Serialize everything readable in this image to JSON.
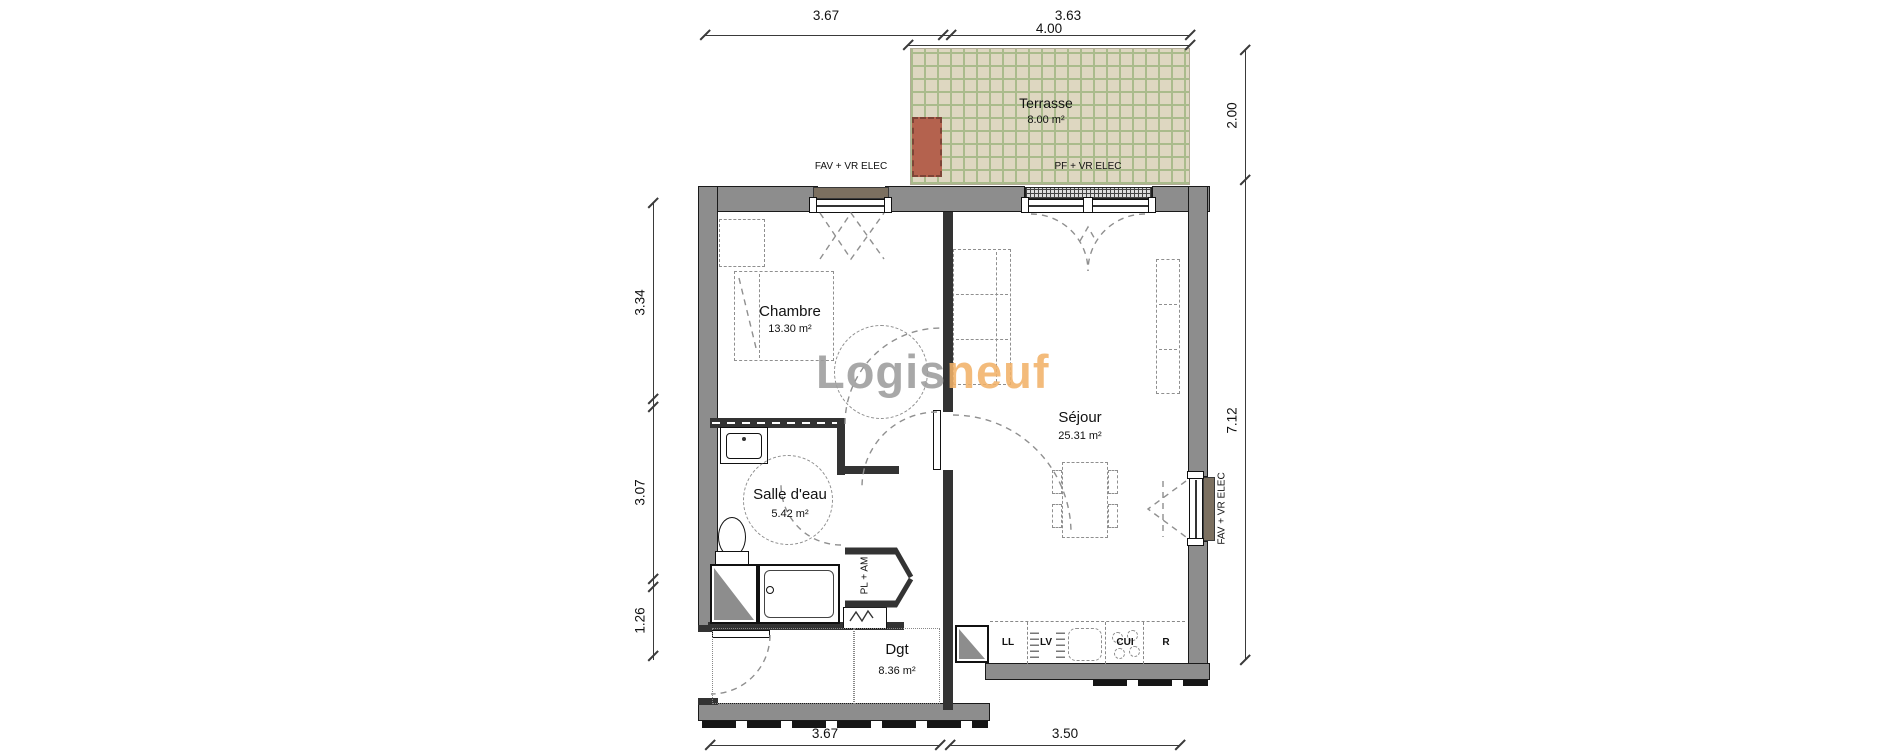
{
  "watermark": {
    "part1": "Logis",
    "part2": "neuf"
  },
  "rooms": {
    "terrasse": {
      "name": "Terrasse",
      "area": "8.00 m²"
    },
    "chambre": {
      "name": "Chambre",
      "area": "13.30 m²"
    },
    "sejour": {
      "name": "Séjour",
      "area": "25.31 m²"
    },
    "salle_eau": {
      "name": "Salle d'eau",
      "area": "5.42 m²"
    },
    "dgt": {
      "name": "Dgt",
      "area": "8.36 m²"
    }
  },
  "windows": {
    "fav_top": "FAV + VR ELEC",
    "pf_top": "PF + VR ELEC",
    "fav_right": "FAV + VR ELEC"
  },
  "closet": {
    "label": "PL + AM"
  },
  "kitchen": {
    "ll": "LL",
    "lv": "LV",
    "cui": "CUI",
    "r": "R"
  },
  "dimensions": {
    "top_left": "3.67",
    "top_right": "3.63",
    "terrace": "4.00",
    "right_upper": "2.00",
    "right_lower": "7.12",
    "left_upper": "3.34",
    "left_middle": "3.07",
    "left_lower": "1.26",
    "bottom_left": "3.67",
    "bottom_right": "3.50"
  },
  "colors": {
    "terrace_tile": "#ded7c1",
    "terrace_grid": "#aabb8c",
    "planter": "#b4624e",
    "shutter_box": "#7c7060",
    "wall": "#8d8d8d",
    "watermark_gray": "#9d9d9d",
    "watermark_orange": "#f2b269"
  }
}
